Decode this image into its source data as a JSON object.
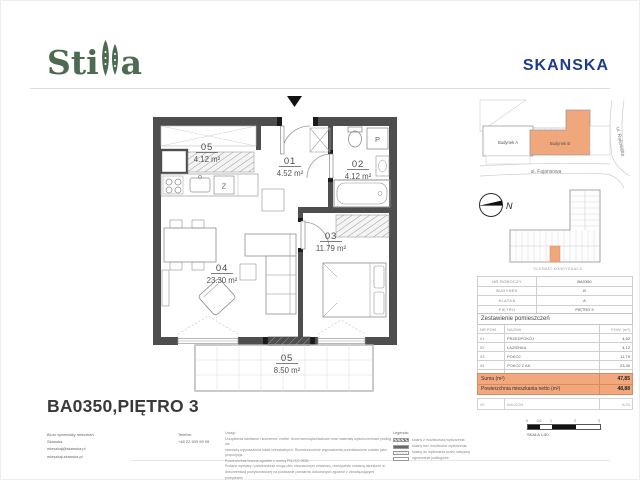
{
  "brand": {
    "logo_prefix": "Sti",
    "logo_suffix": "a",
    "developer": "SKANSKA"
  },
  "colors": {
    "accent_orange": "#F2A87C",
    "skanska_navy": "#1D3C8F",
    "stilla_green": "#4C6B50",
    "wall_gray": "#4E4E4E"
  },
  "plan": {
    "rooms": [
      {
        "num": "05",
        "area": "4.12 m²"
      },
      {
        "num": "01",
        "area": "4.52 m²"
      },
      {
        "num": "02",
        "area": "4.12 m²"
      },
      {
        "num": "03",
        "area": "11.79 m²"
      },
      {
        "num": "04",
        "area": "23.30 m²"
      },
      {
        "num": "05",
        "area": "8.50 m²"
      }
    ],
    "labels": {
      "dishwasher": "Z",
      "washer": "P"
    }
  },
  "site_map": {
    "building_a": "Budynek A",
    "building_b": "Budynek B",
    "street_bottom": "ul. Fajansowa",
    "street_right": "ul. Rakowska"
  },
  "compass": {
    "label": "N"
  },
  "floor_schematic": {
    "caption": "SCHEMAT KONDYGNACJI"
  },
  "info_table": {
    "rows": [
      {
        "label": "NR ROBOCZY",
        "value": "BA0350"
      },
      {
        "label": "BUDYNEK",
        "value": "B"
      },
      {
        "label": "KLATKA",
        "value": "A"
      },
      {
        "label": "PIĘTRO",
        "value": "PIĘTRO 3"
      }
    ]
  },
  "rooms_table": {
    "title": "Zestawienie pomieszczeń",
    "headers": [
      "NR POM.",
      "NAZWA",
      "POW. (m²)"
    ],
    "rows": [
      {
        "no": "01",
        "name": "PRZEDPOKÓJ",
        "area": "4,52"
      },
      {
        "no": "02",
        "name": "ŁAZIENKA",
        "area": "4,12"
      },
      {
        "no": "03",
        "name": "POKÓJ",
        "area": "11,79"
      },
      {
        "no": "04",
        "name": "POKÓJ Z AK.",
        "area": "23,30"
      },
      {
        "no": "05",
        "name": "ANEKS GARDEROB.",
        "area": "4,12"
      }
    ]
  },
  "summary": {
    "rows": [
      {
        "label": "Suma (m²)",
        "value": "47,85"
      },
      {
        "label": "Powierzchnia mieszkania netto (m²)",
        "value": "48,88"
      }
    ]
  },
  "balcony_row": {
    "no": "05",
    "name": "BALKON",
    "area": "8,50"
  },
  "scale_bar": {
    "ticks": [
      "0",
      "0.5",
      "1",
      "2",
      "3"
    ],
    "label": "SKALA 1:50"
  },
  "title_block": {
    "apartment": "BA0350,PIĘTRO 3"
  },
  "footer": {
    "office": [
      "Biuro sprzedaży mieszkań",
      "Skanska",
      "mieszkaj@skanska.pl",
      "mieszkaj.skanska.pl"
    ],
    "phone_label": "Telefon:",
    "phone": "+48 22 509 99 99",
    "notes_label": "Uwagi:",
    "notes": [
      "Urządzenia sanitarne i kuchenne, meble, drzwi wewnątrzlokalowe oraz materiały wykończeniowe podłóg nie",
      "stanowią wyposażenia lokali mieszkalnych. Rozmieszczenie wyposażenia przedstawione zostało jako propozycja.",
      "Powierzchnia liczona zgodnie z normą PN-ISO 9836.",
      "Podane wymiary i powierzchnie mogą ulec nieznacznym zmianom, rzeczywiste zostaną określone w",
      "dokumentacji powykonawczej na podstawie pomiarów dokonanych zgodnie z obowiązującymi przepisami.",
      "Powierzchnia netto mieszkania uwzględnia powierzchnię zajmowaną przez ścianki działowe."
    ],
    "legend_label": "Legenda:",
    "legend": [
      {
        "label": "ściany z możliwością wyburzenia"
      },
      {
        "label": "ściany bez możliwości wyburzenia"
      },
      {
        "label": "ściany do wykonania przez nabywcę"
      },
      {
        "label": "ogrzewanie podłogowe"
      }
    ]
  }
}
